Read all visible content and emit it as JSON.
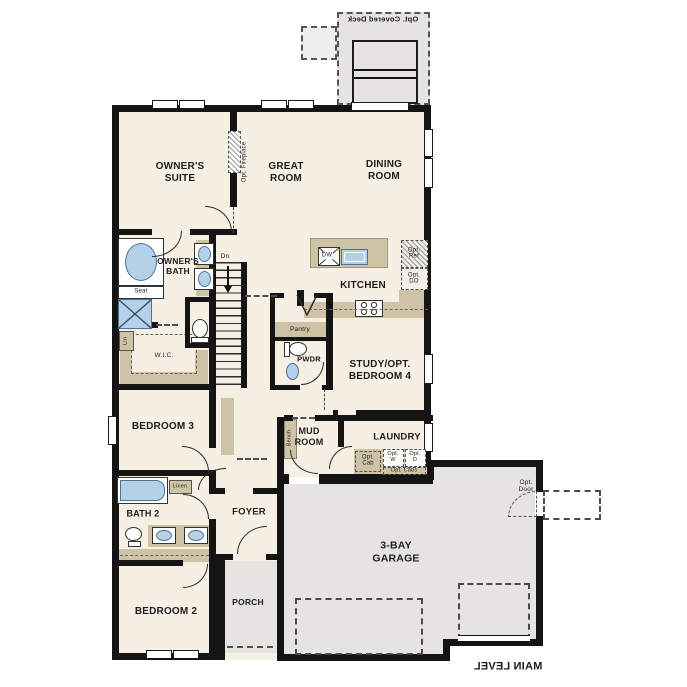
{
  "plan_labels": {
    "deck": "Opt. Covered Deck",
    "owners_suite": "OWNER'S\nSUITE",
    "great_room": "GREAT\nROOM",
    "dining_room": "DINING\nROOM",
    "opt_fireplace": "Opt. Fireplace",
    "owners_bath": "OWNER'S\nBATH",
    "seat": "Seat",
    "lin": "Lin",
    "dn": "Dn",
    "kitchen": "KITCHEN",
    "dw": "DW",
    "opt_ref": "Opt.\nRef",
    "opt_do": "Opt.\nDO",
    "pantry": "Pantry",
    "pwdr": "PWDR",
    "study": "STUDY/OPT.\nBEDROOM 4",
    "wic": "W.I.C.",
    "bedroom3": "BEDROOM 3",
    "mud_room": "MUD\nROOM",
    "bench": "Bench",
    "laundry": "LAUNDRY",
    "opt_cab": "Opt.\nCab",
    "opt_w": "Opt.\nW",
    "opt_d": "Opt.\nD",
    "opt_cabs": "Opt. Cabs",
    "linen": "Linen",
    "bath2": "BATH 2",
    "foyer": "FOYER",
    "bedroom2": "BEDROOM 2",
    "porch": "PORCH",
    "garage": "3-BAY\nGARAGE",
    "opt_door": "Opt.\nDoor",
    "main_level": "MAIN LEVEL"
  },
  "colors": {
    "wall": "#141414",
    "interior_floor": "#f6f0e4",
    "hard_floor": "#e5e4e2",
    "casework": "#cfc3a6",
    "fixture_blue": "#b5d1e8"
  }
}
